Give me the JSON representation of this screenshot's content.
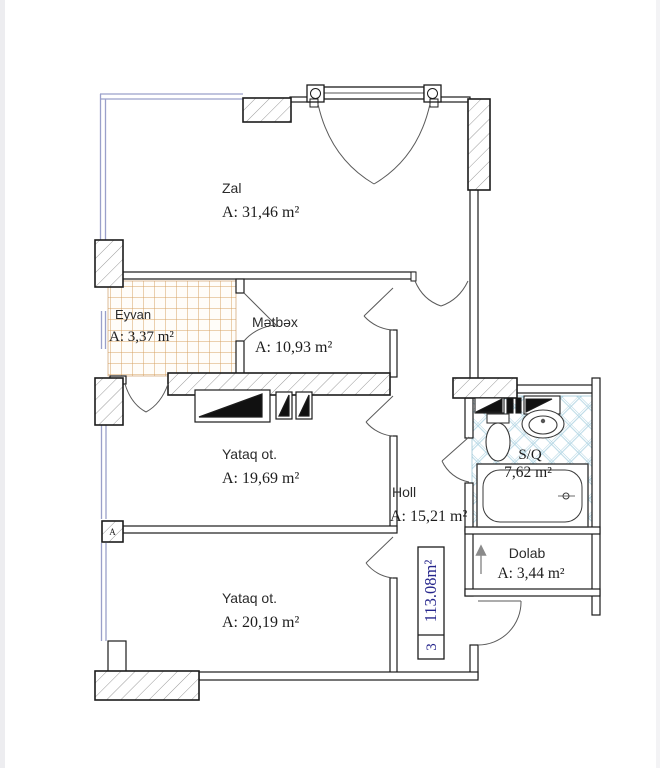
{
  "floor_plan": {
    "unit_info": {
      "room_count": "3",
      "total_area": "113.08m²"
    },
    "wall_marker": "A",
    "rooms": [
      {
        "name": "Zal",
        "area": "A: 31,46 m²"
      },
      {
        "name": "Eyvan",
        "area": "A: 3,37 m²"
      },
      {
        "name": "Mətbəx",
        "area": "A: 10,93 m²"
      },
      {
        "name": "Yataq ot.",
        "area": "A: 19,69 m²"
      },
      {
        "name": "Holl",
        "area": "A: 15,21 m²"
      },
      {
        "name": "S/Q",
        "area": "7,62 m²"
      },
      {
        "name": "Dolab",
        "area": "A: 3,44 m²"
      },
      {
        "name": "Yataq ot.",
        "area": "A: 20,19 m²"
      }
    ],
    "colors": {
      "wall": "#1c1c1c",
      "window_glass": "#9aa0ca",
      "balcony_tile": "#d7a263",
      "bath_tile": "#aed3e2",
      "unit_label_text": "#26268c"
    }
  }
}
